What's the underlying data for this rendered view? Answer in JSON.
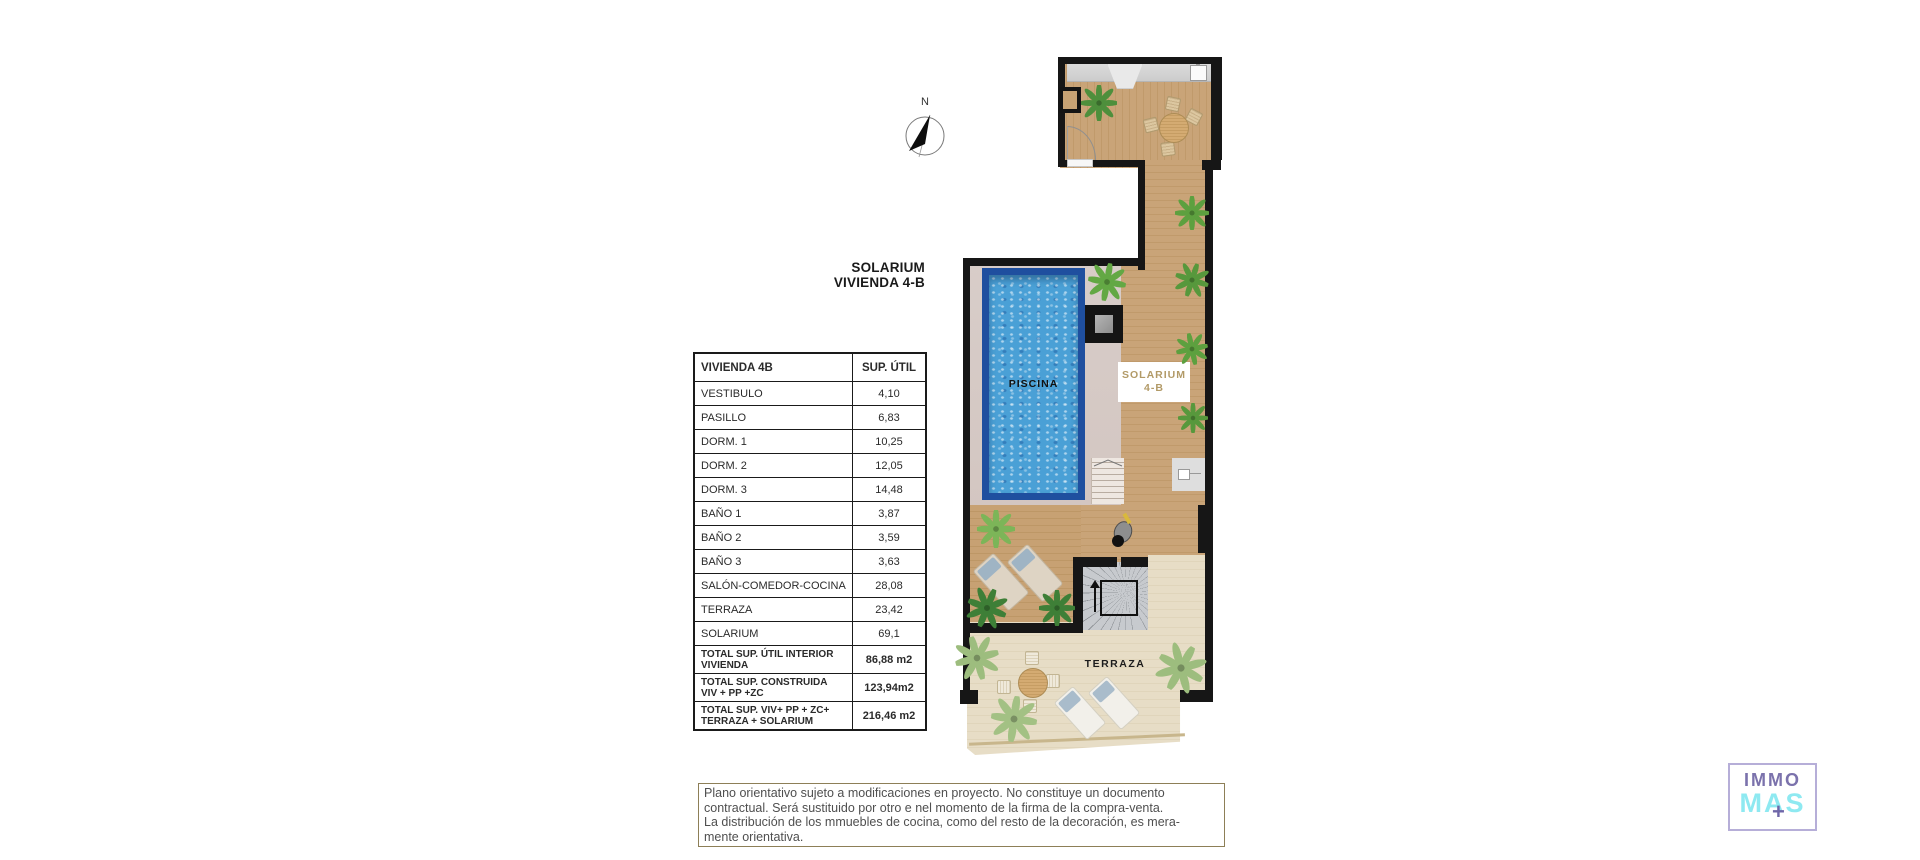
{
  "compass": {
    "label": "N"
  },
  "plan_title": {
    "line1": "SOLARIUM",
    "line2": "VIVIENDA 4-B"
  },
  "area_table": {
    "header": {
      "col1": "VIVIENDA 4B",
      "col2": "SUP. ÚTIL"
    },
    "rows": [
      {
        "label": "VESTIBULO",
        "value": "4,10"
      },
      {
        "label": "PASILLO",
        "value": "6,83"
      },
      {
        "label": "DORM. 1",
        "value": "10,25"
      },
      {
        "label": "DORM. 2",
        "value": "12,05"
      },
      {
        "label": "DORM. 3",
        "value": "14,48"
      },
      {
        "label": "BAÑO 1",
        "value": "3,87"
      },
      {
        "label": "BAÑO 2",
        "value": "3,59"
      },
      {
        "label": "BAÑO 3",
        "value": "3,63"
      },
      {
        "label": "SALÓN-COMEDOR-COCINA",
        "value": "28,08"
      },
      {
        "label": "TERRAZA",
        "value": "23,42"
      },
      {
        "label": "SOLARIUM",
        "value": "69,1"
      }
    ],
    "totals": [
      {
        "line1": "TOTAL SUP. ÚTIL INTERIOR",
        "line2": "VIVIENDA",
        "value": "86,88 m2"
      },
      {
        "line1": "TOTAL SUP. CONSTRUIDA",
        "line2": "VIV + PP +ZC",
        "value": "123,94m2"
      },
      {
        "line1": "TOTAL SUP. VIV+ PP + ZC+",
        "line2": "TERRAZA + SOLARIUM",
        "value": "216,46 m2"
      }
    ]
  },
  "plan_labels": {
    "pool": "PISCINA",
    "solarium_line1": "SOLARIUM",
    "solarium_line2": "4-B",
    "terraza": "TERRAZA"
  },
  "disclaimer": {
    "lines": [
      "Plano orientativo sujeto a modificaciones en proyecto. No constituye un documento",
      "contractual. Será sustituido por otro e nel momento de la firma de la compra-venta.",
      "La distribución de los mmuebles de cocina, como del resto de la decoración, es mera-",
      "mente orientativa."
    ]
  },
  "logo": {
    "line1": "IMMO",
    "line2": "MAS",
    "plus": "+"
  },
  "colors": {
    "wall": "#161616",
    "pool_border": "#1f4f9f",
    "pool_water": "#4aa0d6",
    "wood_floor": "#c7a074",
    "solarium_deck": "#d6cbc7",
    "terraza_floor": "#e6dcc5",
    "solarium_label_text": "#b29a67",
    "logo_purple": "#7b72ac",
    "logo_cyan": "#8ee9f1"
  }
}
